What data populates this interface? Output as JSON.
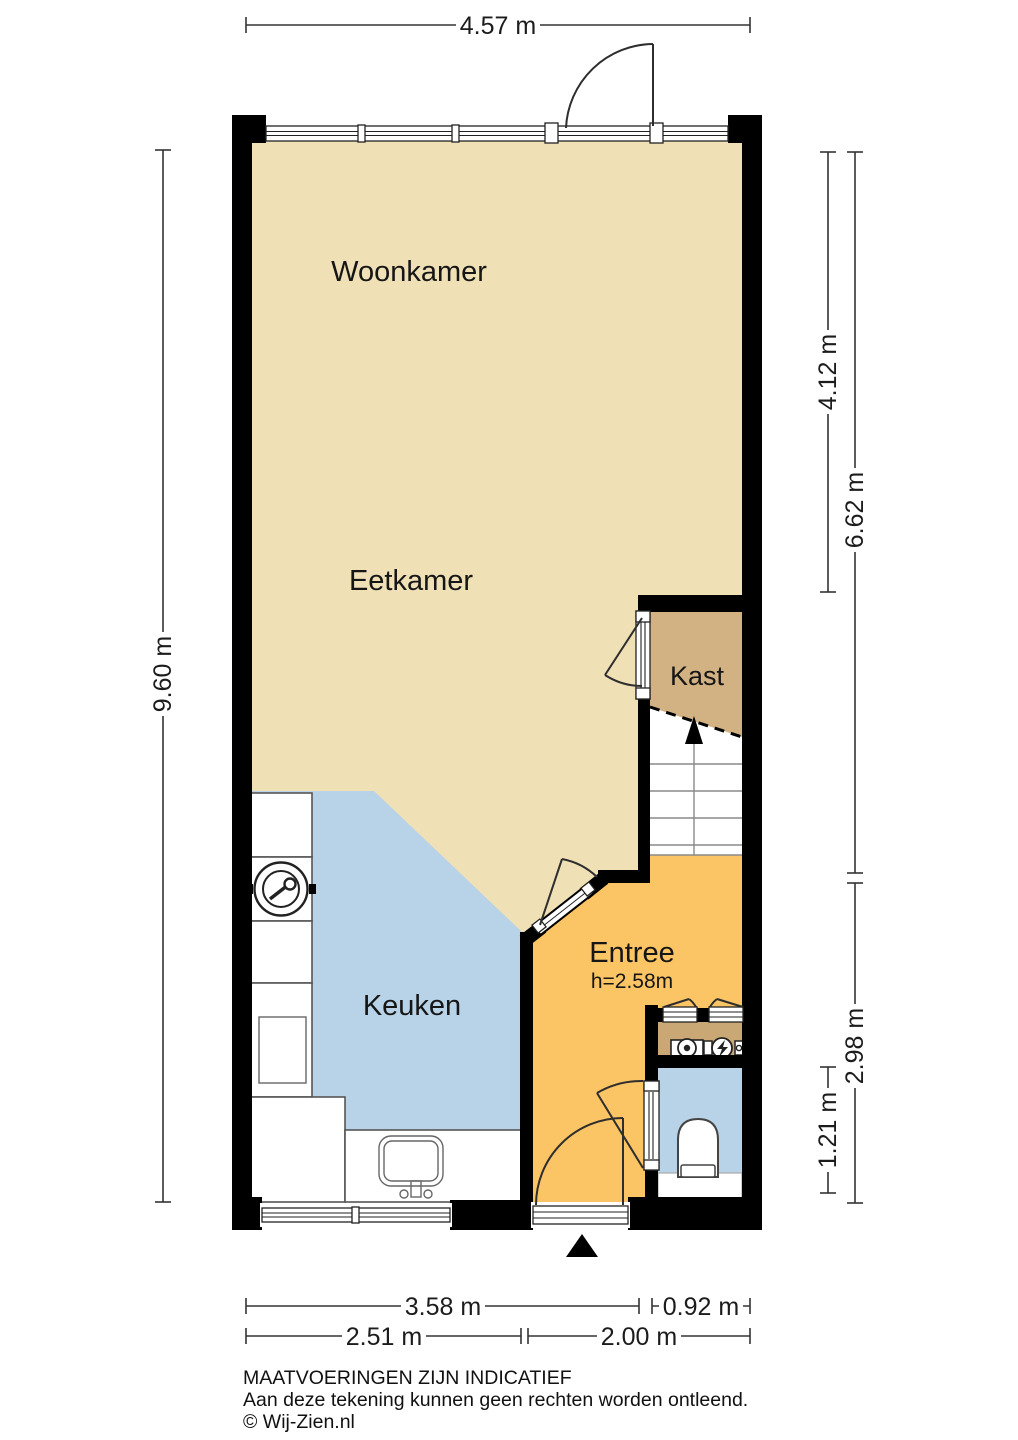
{
  "meta": {
    "type": "floor-plan",
    "language": "nl"
  },
  "rooms": {
    "woonkamer": "Woonkamer",
    "eetkamer": "Eetkamer",
    "kast": "Kast",
    "keuken": "Keuken",
    "entree": "Entree",
    "entree_height": "h=2.58m"
  },
  "dimensions": {
    "top": "4.57 m",
    "left": "9.60 m",
    "right": [
      "4.12 m",
      "6.62 m",
      "2.98 m",
      "1.21 m"
    ],
    "bottom": [
      "3.58 m",
      "0.92 m",
      "2.51 m",
      "2.00 m"
    ]
  },
  "footer": {
    "disclaimer1": "MAATVOERINGEN ZIJN INDICATIEF",
    "disclaimer2": "Aan deze tekening kunnen geen rechten worden ontleend.",
    "copyright": "© Wij-Zien.nl"
  },
  "icons": {
    "stairs": "stairs-up-arrow-icon",
    "entrance": "entrance-triangle-icon",
    "appliances": [
      "washing-machine-icon",
      "kitchen-sink-icon",
      "toilet-icon",
      "water-meter-icon",
      "electricity-meter-icon"
    ]
  },
  "colors": {
    "wall": "#000000",
    "living": "#F0E0B6",
    "kitchen": "#B8D3E7",
    "hall": "#FBC464",
    "closet": "#D2B183",
    "meter_closet": "#C9A875",
    "toilet": "#B8D3E7",
    "dim_line": "#333333"
  }
}
